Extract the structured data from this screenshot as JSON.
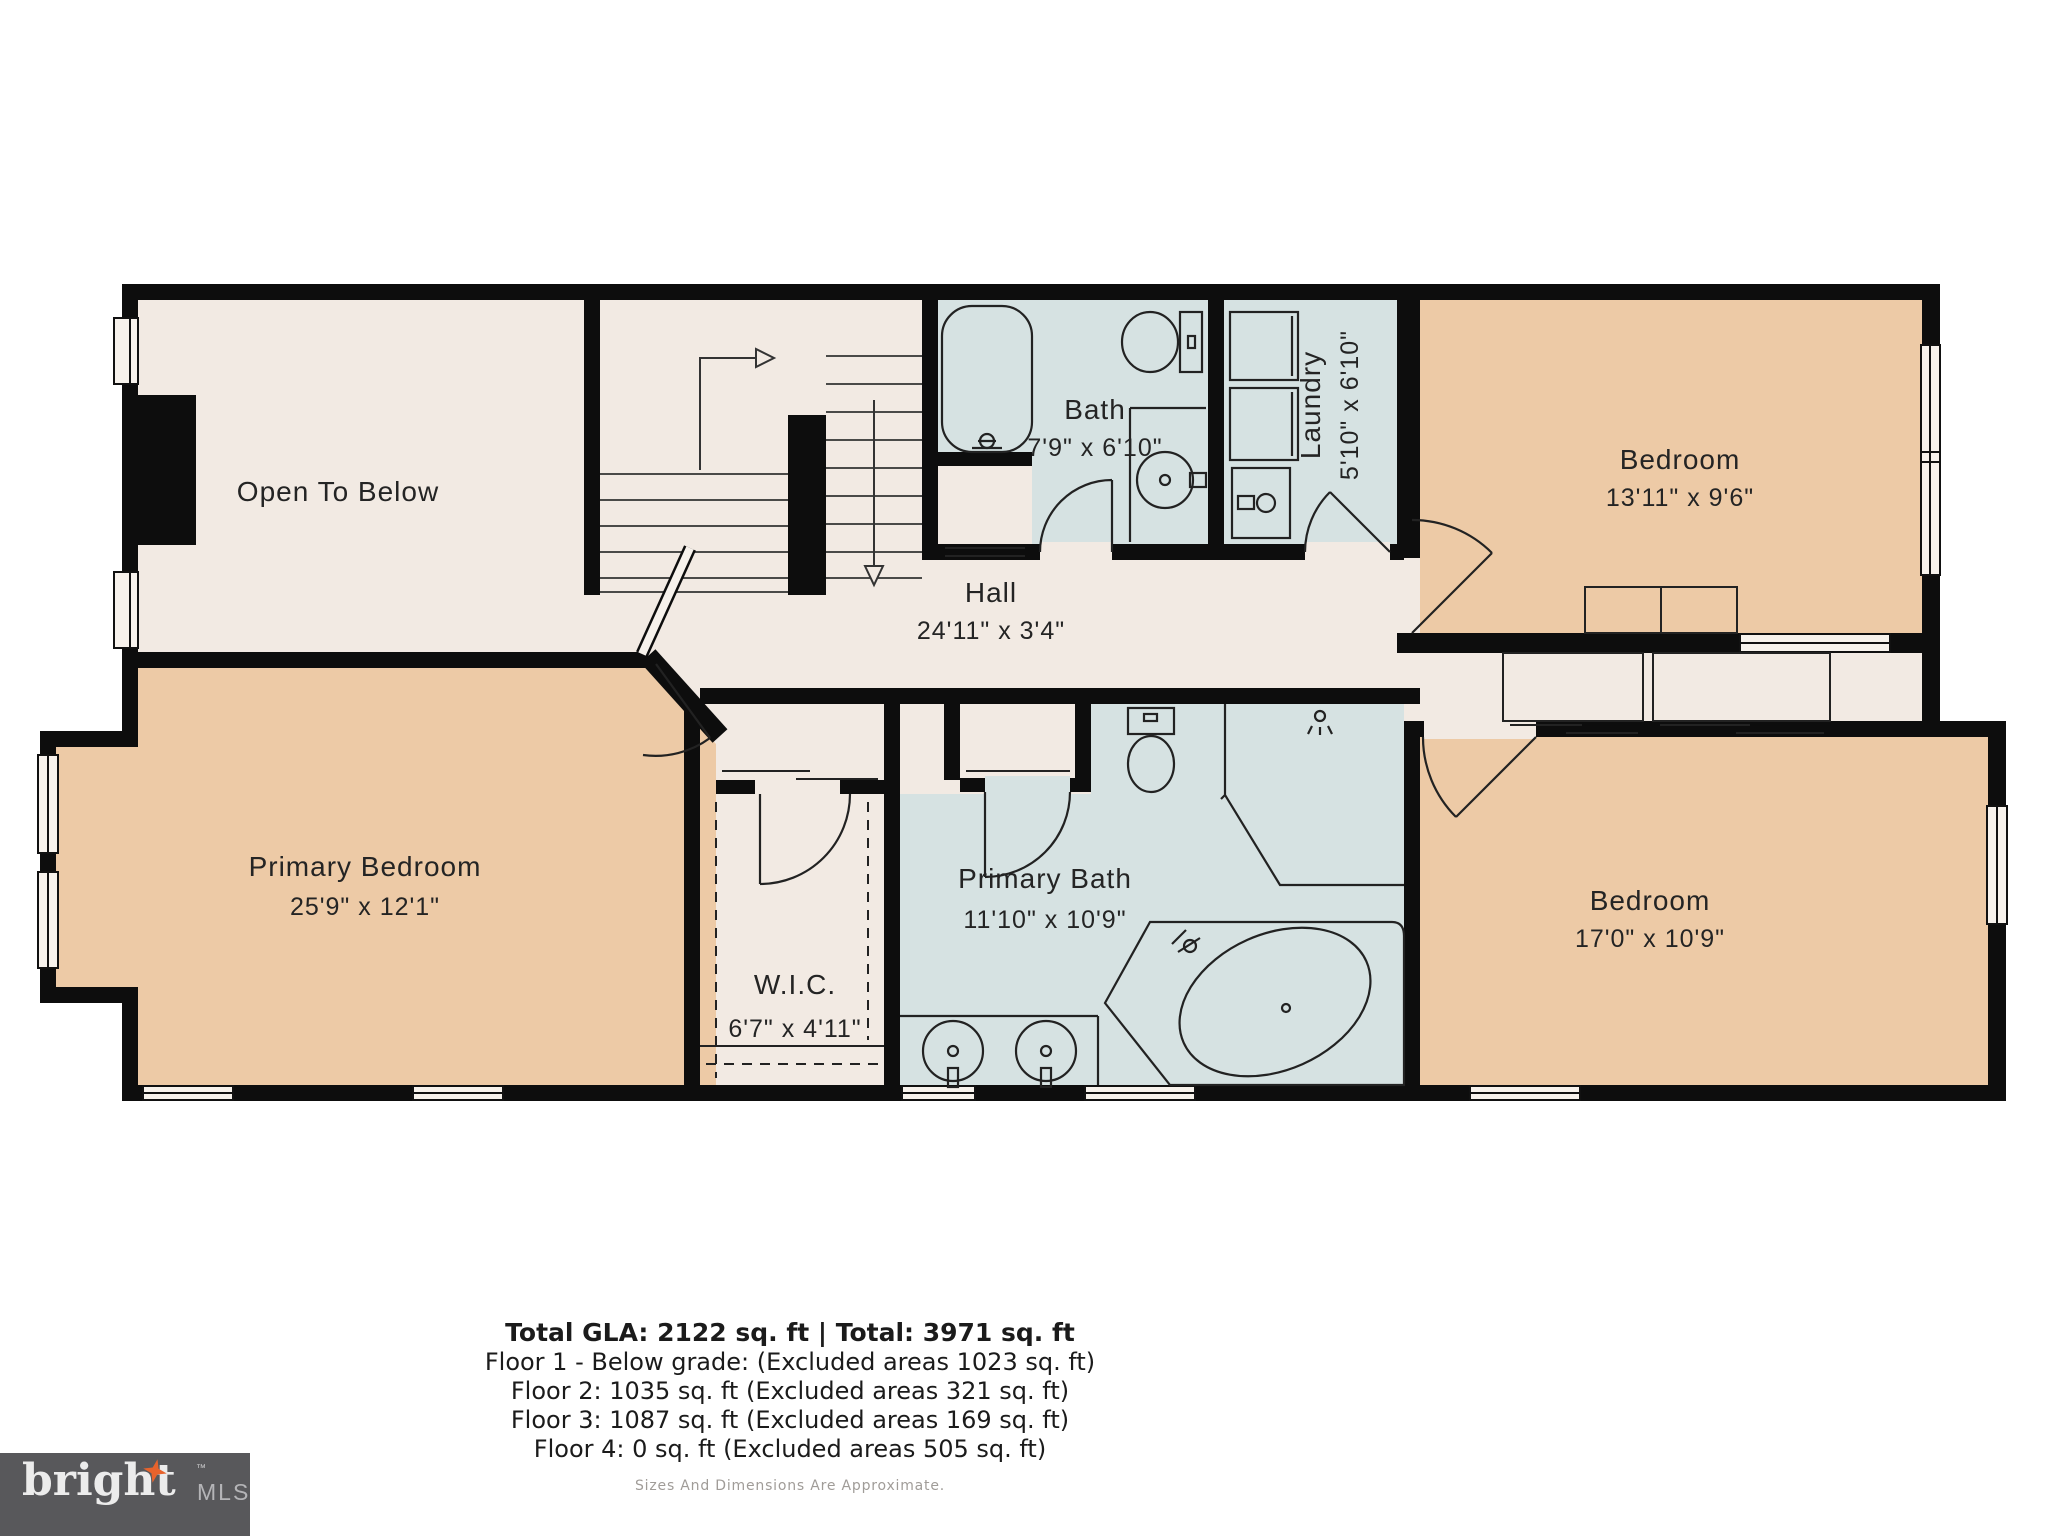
{
  "colors": {
    "wall": "#0d0d0d",
    "room_cream": "#f2eae3",
    "room_tan": "#edcaa6",
    "room_blue": "#d6e2e2",
    "window_fill": "#f7f2ec",
    "fixture_stroke": "#222222",
    "logo_bg": "#58585b",
    "logo_star": "#e8632c"
  },
  "rooms": {
    "open_to_below": {
      "name": "Open To Below"
    },
    "bath": {
      "name": "Bath",
      "dims": "7'9\" x 6'10\""
    },
    "laundry": {
      "name": "Laundry",
      "dims": "5'10\" x 6'10\""
    },
    "bedroom_top": {
      "name": "Bedroom",
      "dims": "13'11\" x 9'6\""
    },
    "hall": {
      "name": "Hall",
      "dims": "24'11\" x 3'4\""
    },
    "primary_bedroom": {
      "name": "Primary Bedroom",
      "dims": "25'9\" x 12'1\""
    },
    "wic": {
      "name": "W.I.C.",
      "dims": "6'7\" x 4'11\""
    },
    "primary_bath": {
      "name": "Primary Bath",
      "dims": "11'10\" x 10'9\""
    },
    "bedroom_bottom": {
      "name": "Bedroom",
      "dims": "17'0\" x 10'9\""
    }
  },
  "summary": {
    "total_line": "Total GLA: 2122 sq. ft | Total: 3971 sq. ft",
    "floors": [
      "Floor 1 - Below grade: (Excluded areas 1023 sq. ft)",
      "Floor 2: 1035 sq. ft (Excluded areas 321 sq. ft)",
      "Floor 3: 1087 sq. ft (Excluded areas 169 sq. ft)",
      "Floor 4: 0 sq. ft (Excluded areas 505 sq. ft)"
    ],
    "disclaimer": "Sizes And Dimensions Are Approximate."
  },
  "logo": {
    "brand": "bright",
    "tm": "TM",
    "suffix": "MLS"
  }
}
